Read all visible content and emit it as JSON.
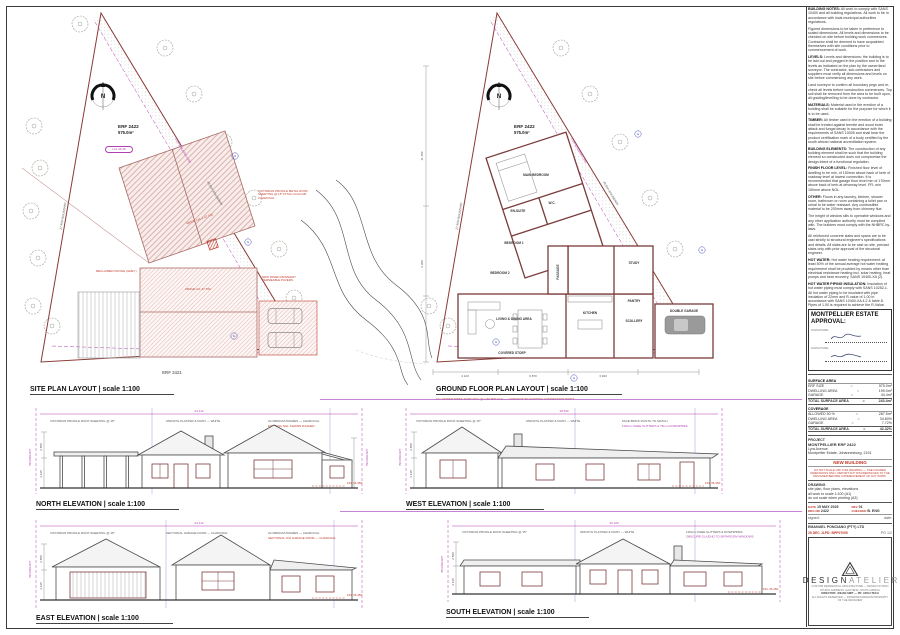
{
  "site_plan": {
    "title": "SITE PLAN LAYOUT | scale 1:100",
    "erf": "ERF 2422",
    "area": "575.0m²",
    "north": "N",
    "lvl": "LVL 46.46",
    "ridge1": "RIDGE LVL 1  47.700",
    "ridge2": "RIDGE LVL  47.700",
    "roof_note": "VICTORIAN PROFILE METAL ROOF SHEETING @ 15° PITCH COLOUR: CHARCOAL",
    "paving_note": "RECLAIMED PAVING (GREY)",
    "garage_note": "NEW PAVED DRIVEWAY PERMEABLE PAVERS",
    "boundary_left": "27.49m BOUNDARY",
    "boundary_hyp": "45.84m BOUNDARY",
    "building_line": "2.0m BUILDING LINE",
    "neighbor": "ERF 2421"
  },
  "floor_plan": {
    "title": "GROUND FLOOR PLAN LAYOUT | scale 1:100",
    "erf": "ERF 2422",
    "area": "575.0m²",
    "erf_num": "2422",
    "north": "N",
    "boundary_left": "27.49m BOUNDARY",
    "boundary_hyp": "45.84m BOUNDARY",
    "building_line": "2.0m BUILDING LINE",
    "note_red": "ALL SEWER PIPES 110Ø uPVC @ 1:60 MIN FALL — CONNECT TO EXISTING CONNECTION POINT",
    "rooms": [
      {
        "label": "MAIN BEDROOM"
      },
      {
        "label": "EN-SUITE"
      },
      {
        "label": "W.C."
      },
      {
        "label": "BEDROOM 1"
      },
      {
        "label": "BEDROOM 2"
      },
      {
        "label": "PASSAGE"
      },
      {
        "label": "STUDY"
      },
      {
        "label": "LIVING & DINING AREA"
      },
      {
        "label": "KITCHEN"
      },
      {
        "label": "SCULLERY"
      },
      {
        "label": "PANTRY"
      },
      {
        "label": "DOUBLE GARAGE"
      },
      {
        "label": "COVERED STOEP"
      }
    ],
    "dims": [
      "4 120",
      "6 870",
      "3 940",
      "11 450",
      "2 380"
    ]
  },
  "elevations": [
    {
      "title": "NORTH ELEVATION | scale 1:100",
      "dim": "24 212",
      "boundary": "BOUNDARY",
      "ffl": "FFL 46.450",
      "vd1": "2 580",
      "vd2": "3 435",
      "extra": "EXISTING NGL SHOWN DASHED",
      "notes": [
        "VICTORIAN PROFILE ROOF SHEETING @ 15°",
        "SMOOTH PLASTER & PAINT — WHITE",
        "ALUMINIUM FRAMES — CHARCOAL"
      ]
    },
    {
      "title": "WEST ELEVATION | scale 1:100",
      "dim": "18 540",
      "boundary": "BOUNDARY",
      "ffl": "FFL 46.450",
      "vd1": "2 580",
      "vd2": "3 435",
      "extra": "115mm OGEE GUTTERS & 75mm DOWNPIPES",
      "notes": [
        "VICTORIAN PROFILE ROOF SHEETING @ 15°",
        "SMOOTH PLASTER & PAINT — WHITE",
        "FACE BRICK PLINTH TO MATCH"
      ]
    },
    {
      "title": "EAST ELEVATION | scale 1:100",
      "dim": "24 212",
      "boundary": "BOUNDARY",
      "ffl": "FFL 46.450",
      "vd1": "2 580",
      "vd2": "3 435",
      "extra": "SECTIONAL O/H GARAGE DOOR — CHARCOAL",
      "notes": [
        "VICTORIAN PROFILE ROOF SHEETING @ 15°",
        "SECTIONAL GARAGE DOOR — CHARCOAL",
        "ALUMINIUM FRAMES — CHARCOAL"
      ]
    },
    {
      "title": "SOUTH ELEVATION | scale 1:100",
      "dim": "30 120",
      "boundary": "BOUNDARY",
      "ffl": "FFL 46.450",
      "vd1": "2 580",
      "vd2": "3 435",
      "extra": "OBSCURE GLAZING TO BATHROOM WINDOWS",
      "notes": [
        "VICTORIAN PROFILE ROOF SHEETING @ 15°",
        "SMOOTH PLASTER & PAINT — WHITE",
        "115mm OGEE GUTTERS & DOWNPIPES"
      ]
    }
  ],
  "titleblock": {
    "notes": [
      {
        "h": "BUILDING NOTES:",
        "t": " All work to comply with SANS 10400 and all building regulations. All work to be in accordance with local municipal authorities regulations."
      },
      {
        "h": "",
        "t": "Figured dimensions to be taken in preference to scaled dimensions. All levels and dimensions to be checked on site before building work commences. Contractor shall be deemed to have acquainted themselves with site conditions prior to commencement of work."
      },
      {
        "h": "LEVELS:",
        "t": " Levels and dimensions: the building is to be laid out and pegged in the position and to the levels as indicated on the plan by the owner/land surveyor. The contractor, sub-contractors and suppliers must verify all dimensions and levels on site before commencing any work."
      },
      {
        "h": "",
        "t": "Land surveyor to confirm all boundary pegs and re-check all levels before construction commences. Top soil shall be removed from the area to be built upon, all grading/levelling to be done by contractor."
      },
      {
        "h": "MATERIALS:",
        "t": " Material used in the erection of a building shall be suitable for the purpose for which it is to be used."
      },
      {
        "h": "TIMBER:",
        "t": " All timber used in the erection of a building shall be treated against termite and wood borer attack and fungal decay in accordance with the requirements of SANS 10005 and shall bear the product certification mark of a body certified by the south african national accreditation system."
      },
      {
        "h": "BUILDING ELEMENTS:",
        "t": " The construction of any building element shall be such that the building element so constructed does not compromise the design intent of a functional regulation."
      },
      {
        "h": "FINISH FLOOR LEVEL:",
        "t": " Finished floor level of dwelling to be min. of 150mm above back of kerb of roadway level at lowest connection. It is recommended that garage floor level min of 170mm above back of kerb at driveway level. FFL min 150mm above NGL."
      },
      {
        "h": "OTHER:",
        "t": " Floors in any laundry, kitchen, shower room, bathroom or room containing a toilet pan or urinal to be water resistant. Any combustible material to be 200mm away from chimney flue."
      },
      {
        "h": "",
        "t": "The height of window sills to openable windows and any other application authority must be complied with. The builders must comply with the NHBRC by-laws."
      },
      {
        "h": "",
        "t": "All reinforced concrete slabs and spans are to be cast strictly to structural engineer's specifications and details. All slabs are to be cast on site, precast slabs only with prior approval of the structural engineer."
      },
      {
        "h": "HOT WATER:",
        "t": " Hot water heating requirement: at least 50% of the annual average hot water heating requirement shall be provided by means other than electrical resistance heating incl. solar heating, heat pumps and heat recovery, SANS 10400-XA (2)."
      },
      {
        "h": "HOT WATER PIPING INSULATION:",
        "t": " Insulation of hot water piping must comply with SANS 10252-1. All hot water piping to be insulated with pipe insulation of 22mm and R-value of 1.00 in accordance with SANS 10400-XA 4.2 & table 8. Pipes of 1.00 is required to achieve the R-Value."
      },
      {
        "h": "ENERGY REGULATION:",
        "t": " All roofs shall achieve a minimum R-value of 3.7 in accordance with SANS 10400-XA 4.2 (b). SINGLE PV/STORAGE INSTALLED PV SYSTEM TO BE DONE BY ACCREDITED INSTALLER."
      }
    ],
    "approval": {
      "line1": "MONTPELLIER ESTATE",
      "line2": "APPROVAL:",
      "sig1": "SIGNATURE:",
      "sig2": "SIGNATURE:"
    },
    "surface": {
      "s1": "SURFACE AREA",
      "rows1": [
        {
          "l": "ERF SIZE",
          "e": "=",
          "v": "575.0m²"
        },
        {
          "l": "DWELLING AREA",
          "e": "=",
          "v": "199.0m²"
        },
        {
          "l": "GARAGE",
          "e": "=",
          "v": "44.4m²"
        },
        {
          "l": "TOTAL SURFACE AREA",
          "e": "=",
          "v": "243.4m²"
        }
      ],
      "s2": "COVERAGE",
      "rows2": [
        {
          "l": "ALLOWED 50 %",
          "e": "=",
          "v": "287.5m²"
        },
        {
          "l": "DWELLING AREA",
          "e": "=",
          "v": "34.60%"
        },
        {
          "l": "GARAGE",
          "e": "=",
          "v": "7.72%"
        },
        {
          "l": "TOTAL SURFACE AREA",
          "e": "=",
          "v": "42.32%"
        }
      ]
    },
    "project": {
      "label": "PROJECT",
      "name": "MONTPELLIER ERF 2422",
      "addr1": "Lyra Avenue",
      "addr2": "Montpellier Estate, Johannesburg, 2191"
    },
    "status": "NEW BUILDING",
    "disclaimer": "DO NOT SCALE OFF THIS DRAWING — USE FIGURED DIMENSIONS ONLY. REPORT ANY DISCREPANCIES TO THE DESIGNER BEFORE COMMENCEMENT OF ANY WORK.",
    "drawing": {
      "label": "DRAWING",
      "l1": "site plan, floor plans, elevations",
      "l2": "all work to scale 1:100 (A1)",
      "l3": "do not scale when printing (A3)"
    },
    "meta": {
      "date_l": "DATE",
      "date_v": "15 MAY 2025",
      "drg_l": "DRG NR",
      "drg_v": "2422",
      "rev_l": "REV",
      "rev_v": "01",
      "chk_l": "CHECKED",
      "chk_v": "B. ENG",
      "signed": "signed:",
      "date2": "date:"
    },
    "company": "EMANUEL PONCIANO (PTY) LTD",
    "stamp": "25 DEC JLPD: BPP07/05/",
    "page": "PG 1/2",
    "logo": {
      "dark": "DESIGN",
      "light": "ATELIER",
      "tag1": "CUSTOM RESIDENTIAL ARCHITECTURE — DESIGN STUDIO",
      "tag2": "STUDIO ADDRESS: GAUTENG, SOUTH AFRICA",
      "tag3": "DIRECTOR: JOHAN SMIT — PR. ARCH TECH",
      "tag4": "ALL RIGHTS RESERVED — DRAWINGS REMAIN PROPERTY OF THE DESIGNER"
    }
  }
}
